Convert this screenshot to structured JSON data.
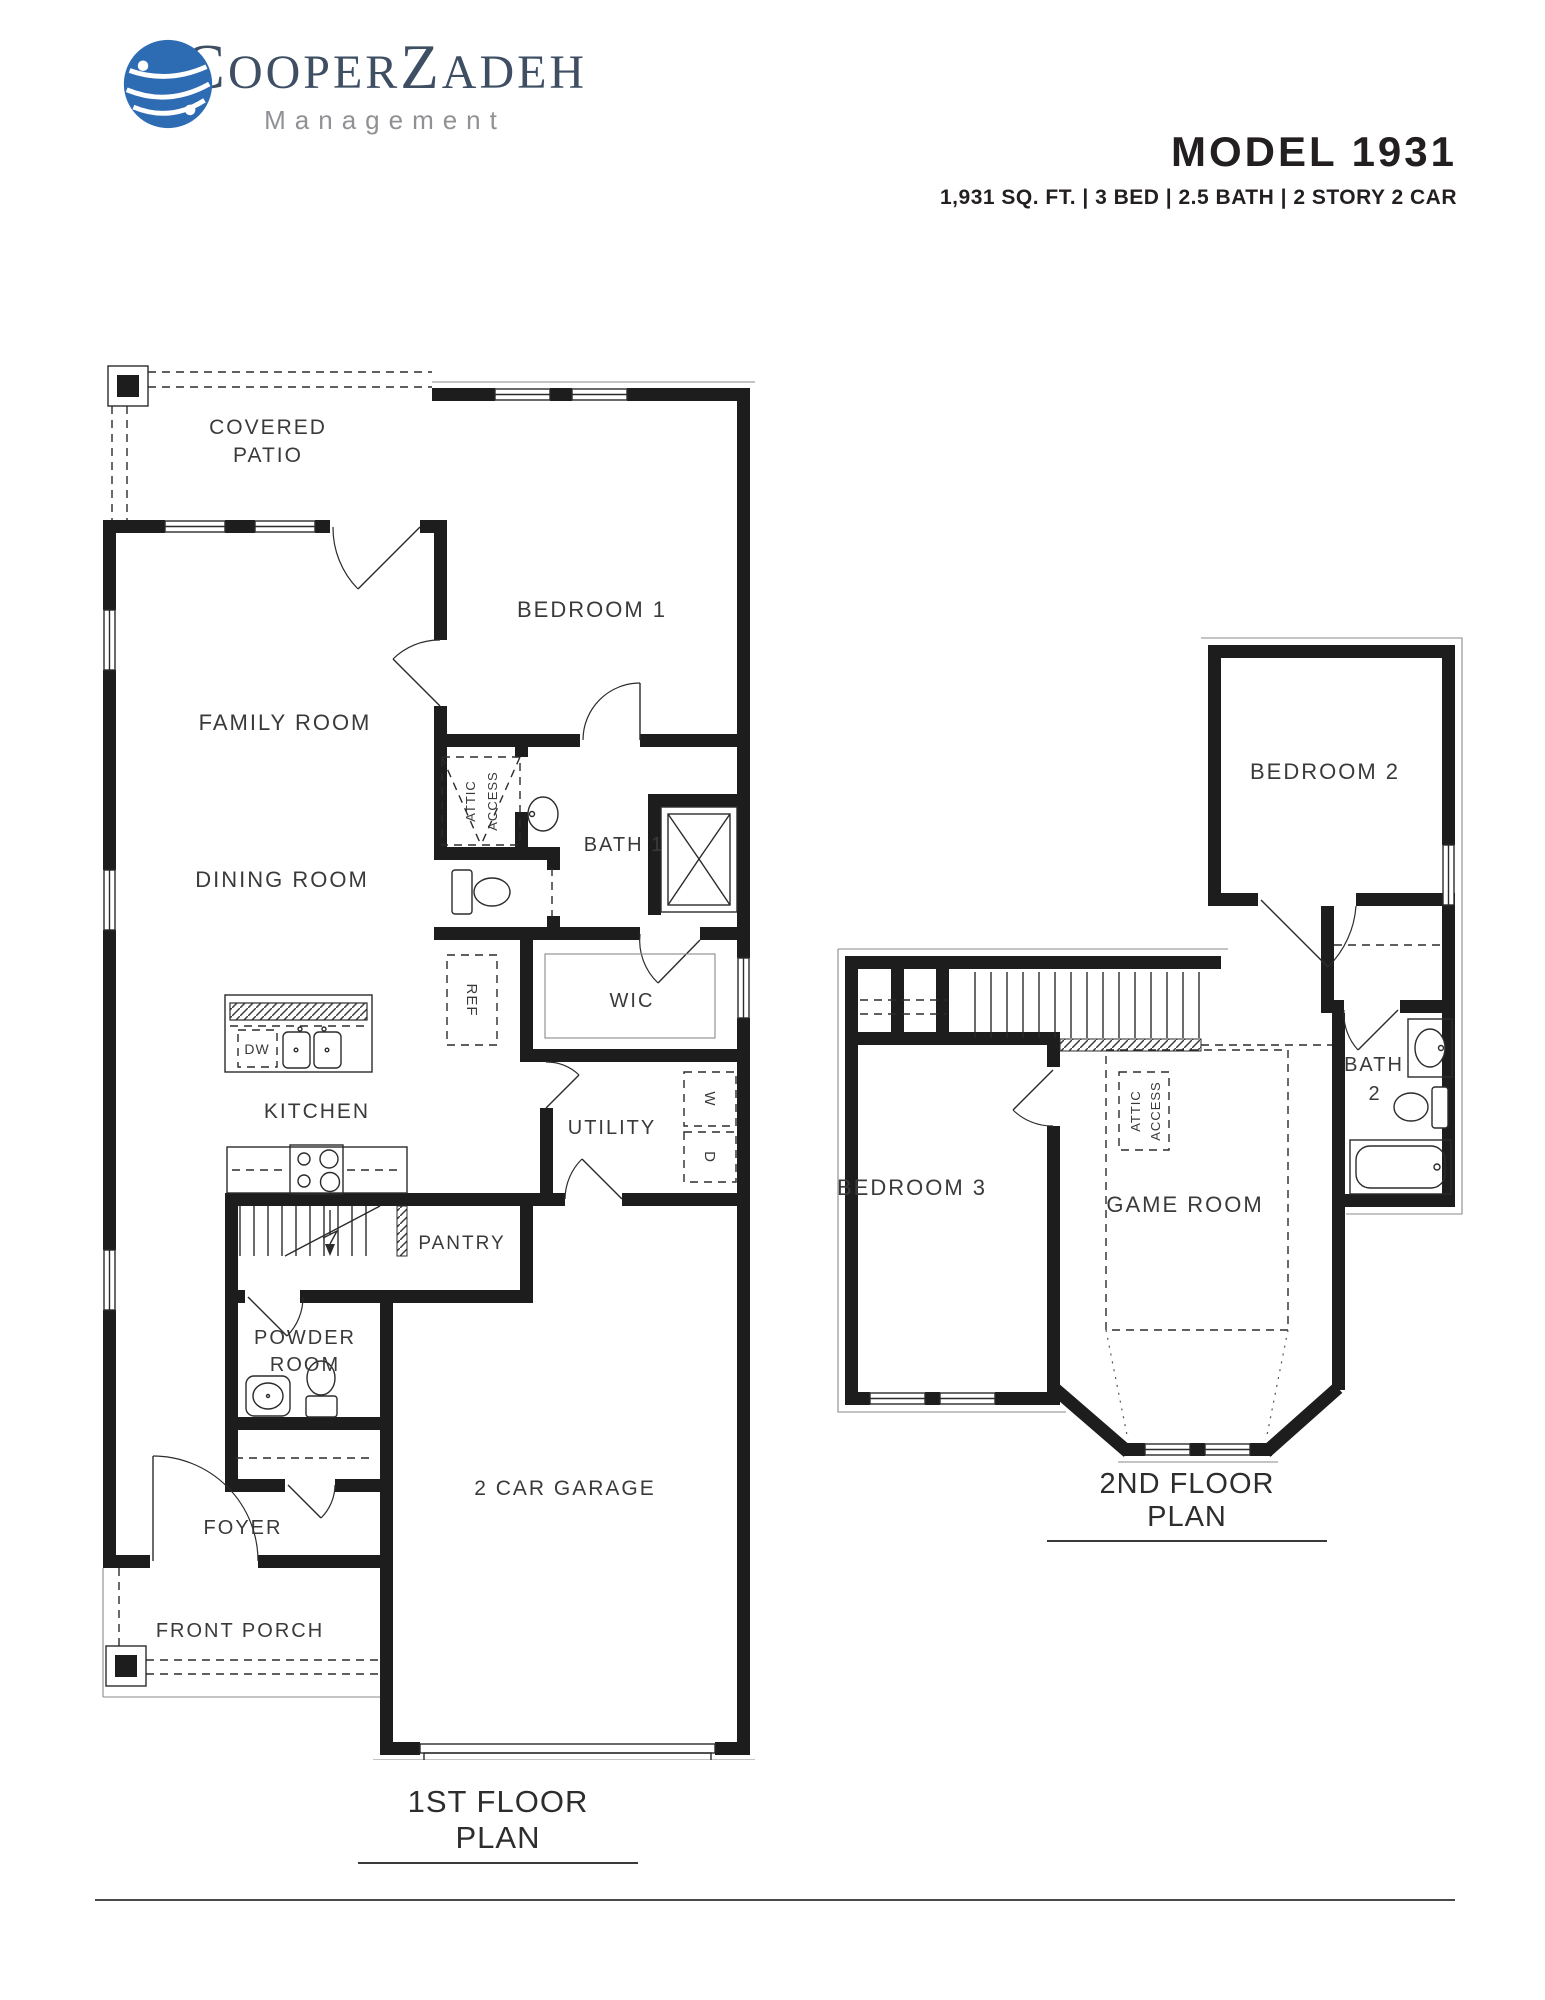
{
  "header": {
    "logo": {
      "icon": "globe-icon",
      "segments": [
        "C",
        "OOPER",
        "Z",
        "ADEH"
      ],
      "tagline": "Management",
      "brand_color": "#3e4e63",
      "tagline_color": "#8f9194",
      "globe_color": "#2d6cb3"
    },
    "model": {
      "title": "MODEL 1931",
      "specs": "1,931 SQ. FT. | 3 BED | 2.5 BATH | 2 STORY 2 CAR"
    }
  },
  "floor1": {
    "title": "1ST FLOOR PLAN",
    "labels": {
      "covered_patio": [
        "COVERED",
        "PATIO"
      ],
      "family_room": "FAMILY ROOM",
      "bedroom1": "BEDROOM 1",
      "attic_access": [
        "ATTIC",
        "ACCESS"
      ],
      "bath1": "BATH 1",
      "dining_room": "DINING ROOM",
      "wic": "WIC",
      "ref": "REF",
      "dw": "DW",
      "kitchen": "KITCHEN",
      "utility": "UTILITY",
      "washer": "W",
      "dryer": "D",
      "pantry": "PANTRY",
      "powder_room": [
        "POWDER",
        "ROOM"
      ],
      "foyer": "FOYER",
      "garage": "2 CAR GARAGE",
      "front_porch": "FRONT PORCH"
    }
  },
  "floor2": {
    "title": "2ND FLOOR PLAN",
    "labels": {
      "bedroom2": "BEDROOM 2",
      "bedroom3": "BEDROOM 3",
      "game_room": "GAME ROOM",
      "bath2": [
        "BATH",
        "2"
      ],
      "attic_access": [
        "ATTIC",
        "ACCESS"
      ]
    }
  }
}
